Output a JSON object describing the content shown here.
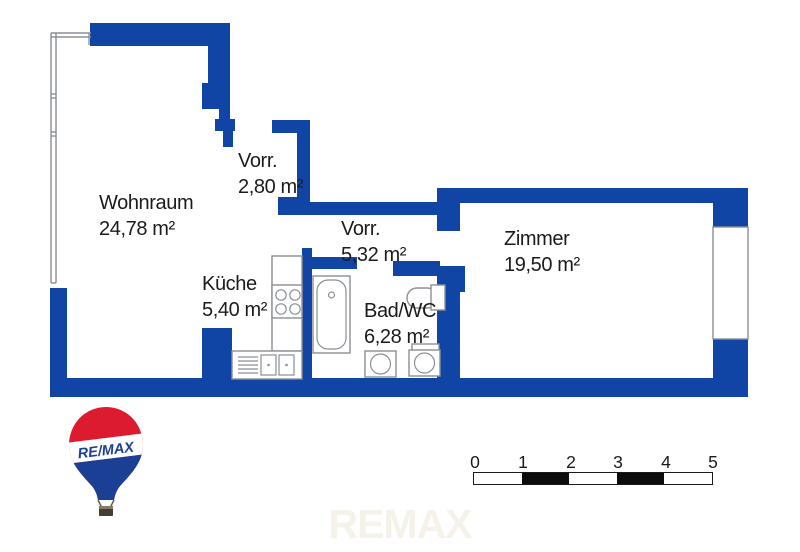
{
  "floorplan": {
    "rooms": [
      {
        "name": "Wohnraum",
        "area": "24,78 m²"
      },
      {
        "name": "Vorr.",
        "area": "2,80 m²"
      },
      {
        "name": "Vorr.",
        "area": "5,32 m²"
      },
      {
        "name": "Küche",
        "area": "5,40 m²"
      },
      {
        "name": "Bad/WC",
        "area": "6,28 m²"
      },
      {
        "name": "Zimmer",
        "area": "19,50 m²"
      }
    ],
    "wall_color": "#1145a5",
    "outline_color": "#8b9095"
  },
  "logo": {
    "brand": "RE/MAX",
    "red": "#dc1c2e",
    "blue": "#1b3f94"
  },
  "scale_bar": {
    "ticks": [
      "0",
      "1",
      "2",
      "3",
      "4",
      "5"
    ]
  },
  "watermark": {
    "text": "REMAX",
    "color": "#f5f2ea"
  }
}
